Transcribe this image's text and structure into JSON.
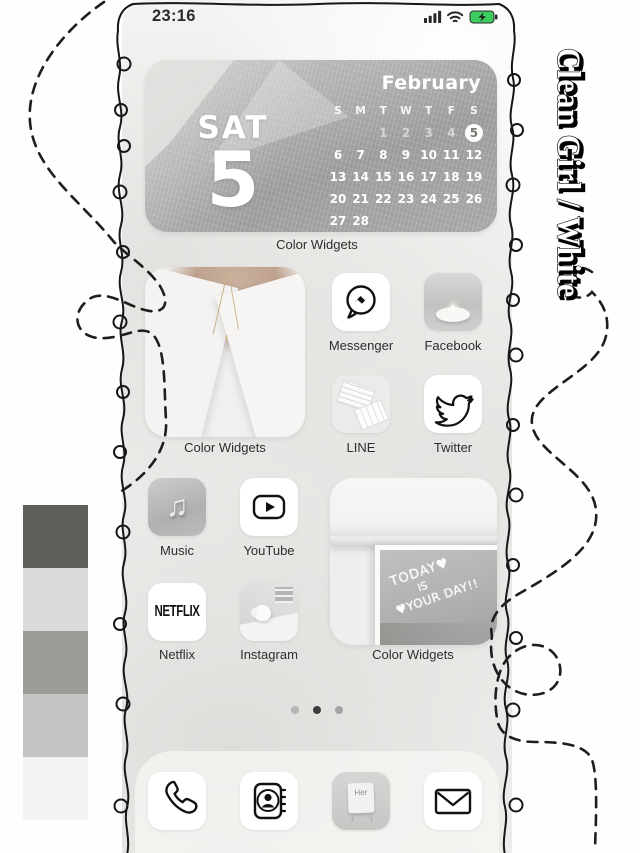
{
  "status_bar": {
    "time": "23:16",
    "icons": [
      "cellular-signal-icon",
      "wifi-icon",
      "battery-charging-icon"
    ]
  },
  "theme_title": "Clean Girl / White",
  "calendar_widget": {
    "day_label": "SAT",
    "day_number": "5",
    "month": "February",
    "weekday_headers": [
      "S",
      "M",
      "T",
      "W",
      "T",
      "F",
      "S"
    ],
    "weeks": [
      [
        "",
        "",
        "1",
        "2",
        "3",
        "4",
        "5"
      ],
      [
        "6",
        "7",
        "8",
        "9",
        "10",
        "11",
        "12"
      ],
      [
        "13",
        "14",
        "15",
        "16",
        "17",
        "18",
        "19"
      ],
      [
        "20",
        "21",
        "22",
        "23",
        "24",
        "25",
        "26"
      ],
      [
        "27",
        "28",
        "",
        "",
        "",
        "",
        ""
      ]
    ],
    "highlighted_date": "5",
    "label": "Color Widgets"
  },
  "photo_widget": {
    "label": "Color Widgets"
  },
  "mirror_widget": {
    "label": "Color Widgets",
    "line1": "TODAY♥",
    "line2": "IS",
    "line3": "♥YOUR DAY!!"
  },
  "apps": {
    "messenger": "Messenger",
    "facebook": "Facebook",
    "line": "LINE",
    "twitter": "Twitter",
    "music": "Music",
    "youtube": "YouTube",
    "netflix": "Netflix",
    "instagram": "Instagram"
  },
  "netflix_logo": "NETFLIX",
  "her_card": "Her",
  "music_note_glyph": "♫",
  "page_dots": {
    "count": 3,
    "active_index": 1
  },
  "palette": [
    "#5d5f58",
    "#dcdad8",
    "#9b9c98",
    "#c3c5c2",
    "#f4f3f1"
  ],
  "dock_items": [
    "phone",
    "contacts",
    "her-photo",
    "mail"
  ]
}
